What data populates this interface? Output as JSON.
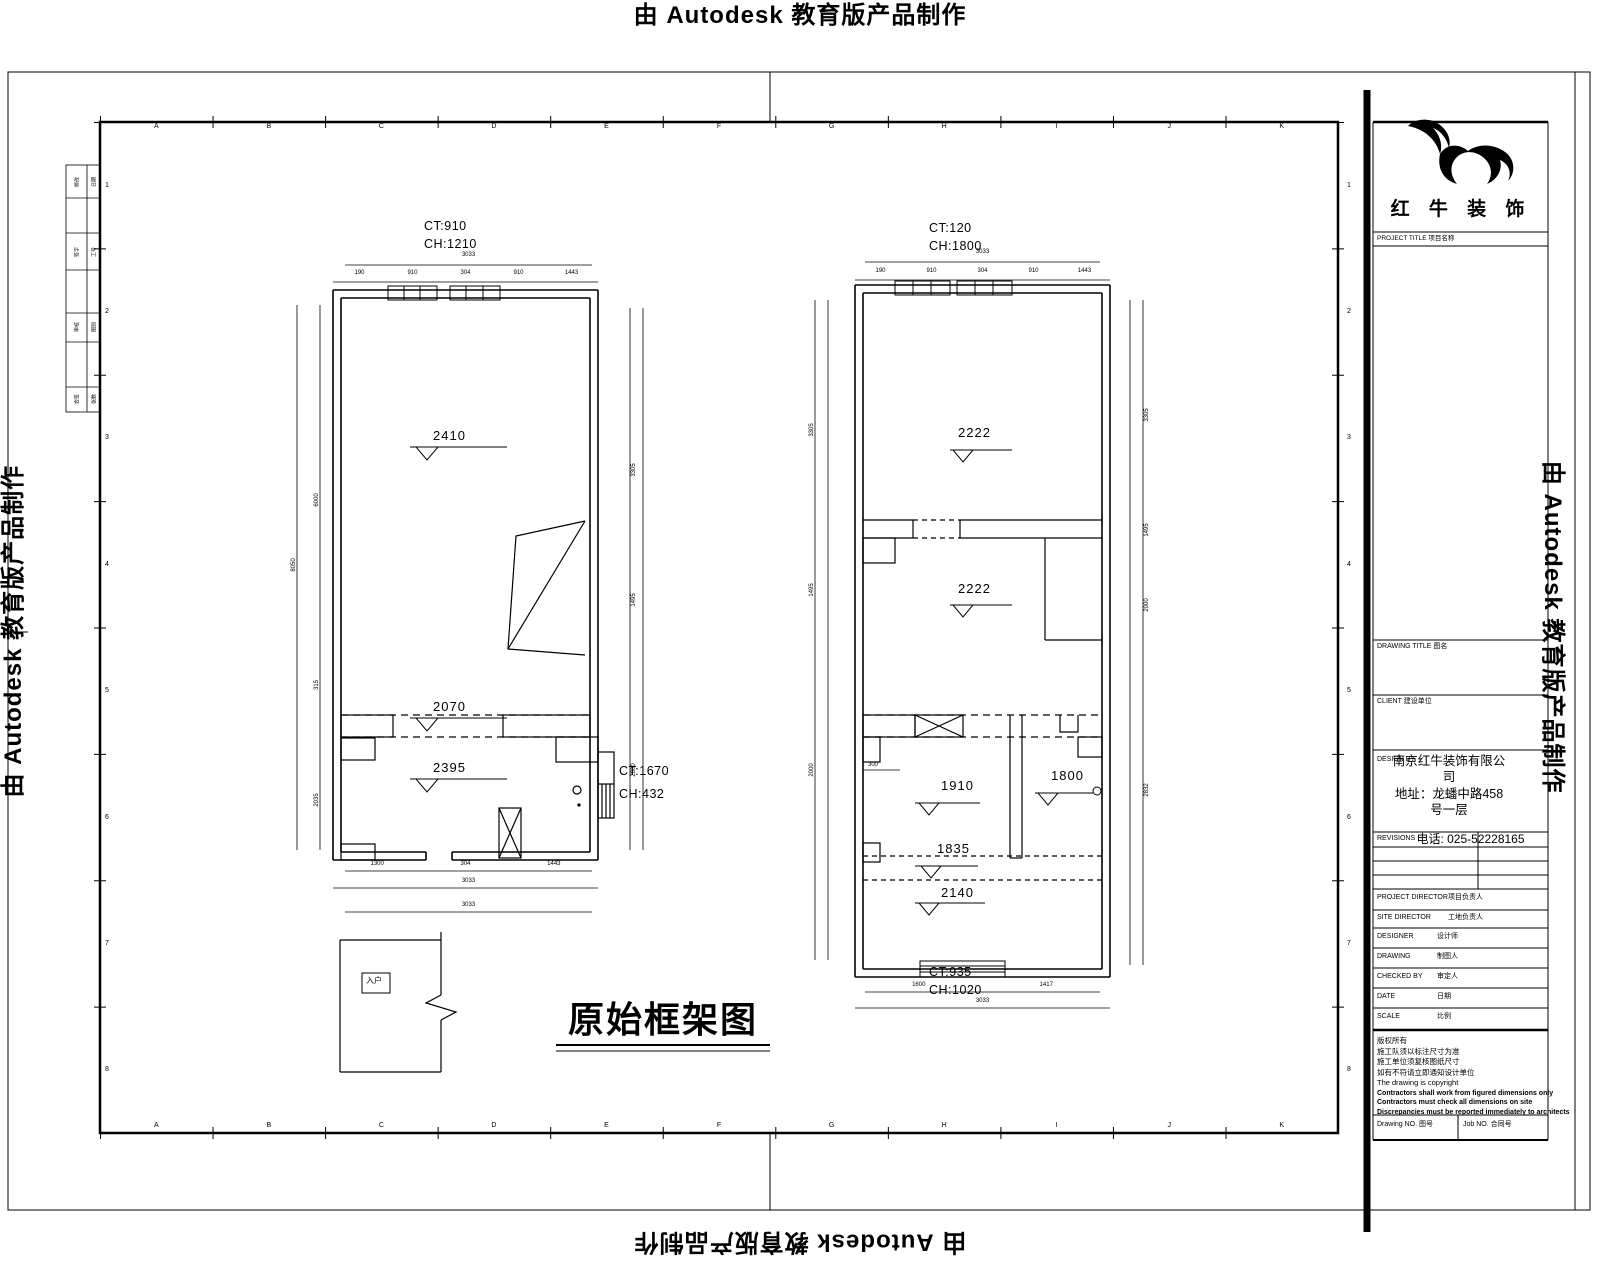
{
  "watermark": {
    "text": "由 Autodesk 教育版产品制作"
  },
  "sheet_title": {
    "text": "原始框架图"
  },
  "grid": {
    "letters": [
      "A",
      "B",
      "C",
      "D",
      "E",
      "F",
      "G",
      "H",
      "I",
      "J",
      "K"
    ],
    "rows": [
      "1",
      "2",
      "3",
      "4",
      "5",
      "6",
      "7",
      "8"
    ]
  },
  "edge_strip": {
    "rows": [
      [
        "修改",
        "日期"
      ],
      [
        "签字",
        "工号"
      ],
      [
        "审核",
        "图别"
      ],
      [
        "会签",
        "张数"
      ]
    ]
  },
  "left_plan": {
    "ct": "CT:910",
    "ch": "CH:1210",
    "levels": {
      "top": "2410",
      "beam": "2070",
      "mid": "2395"
    },
    "side": {
      "ct": "CT:1670",
      "ch": "CH:432"
    },
    "dim_top": {
      "total": "3033",
      "segments": [
        "190",
        "910",
        "304",
        "910",
        "1443"
      ]
    },
    "dim_bottom": {
      "segments": [
        "1300",
        "304",
        "1443"
      ],
      "total": "3033",
      "total2": "3033"
    },
    "dim_left": {
      "total": "8050",
      "segments": [
        "6000",
        "315",
        "2035"
      ]
    },
    "dim_right": {
      "segments": [
        "3305",
        "1495",
        "2000"
      ]
    },
    "balcony_label": "入户"
  },
  "right_plan": {
    "ct": "CT:120",
    "ch": "CH:1800",
    "bottom_ct": "CT:935",
    "bottom_ch": "CH:1020",
    "levels": {
      "room1": "2222",
      "room2": "2222",
      "room3": "1910",
      "room3b": "1800",
      "beam": "1835",
      "room4": "2140"
    },
    "small_dim": "300",
    "dim_top": {
      "total": "3033",
      "segments": [
        "190",
        "910",
        "304",
        "910",
        "1443"
      ]
    },
    "dim_bottom": {
      "segments": [
        "1600",
        "1417"
      ],
      "total": "3033"
    },
    "dim_left": {
      "segments": [
        "3305",
        "1495",
        "2000"
      ]
    },
    "dim_right": {
      "segments": [
        "3305",
        "1495",
        "2000",
        "2832"
      ]
    }
  },
  "titleblock": {
    "brand": "红 牛 装 饰",
    "project_row": "PROJECT TITLE 项目名称",
    "drawing_title_label": "DRAWING TITLE 图名",
    "client_label": "CLIENT 建设单位",
    "design_label": "DESIGN BY",
    "company": "南京红牛装饰有限公司",
    "address": "地址：龙蟠中路458号一层",
    "phone": "电话: 025-52228165",
    "revisions_label": "REVISIONS",
    "rows": [
      {
        "en": "PROJECT DIRECTOR",
        "zh": "项目负责人"
      },
      {
        "en": "SITE DIRECTOR",
        "zh": "工地负责人"
      },
      {
        "en": "DESIGNER",
        "zh": "设计师"
      },
      {
        "en": "DRAWING",
        "zh": "制图人"
      },
      {
        "en": "CHECKED BY",
        "zh": "审定人"
      },
      {
        "en": "DATE",
        "zh": "日期"
      },
      {
        "en": "SCALE",
        "zh": "比例"
      }
    ],
    "notes": [
      "版权所有",
      "施工队须以标注尺寸为准",
      "施工单位须复核图纸尺寸",
      "如有不符请立即通知设计单位",
      "The drawing is copyright",
      "Contractors shall work from figured dimensions only",
      "Contractors must check all dimensions on site",
      "Discrepancies must be reported immediately to architects"
    ],
    "drawing_no_label": "Drawing NO. 图号",
    "job_no_label": "Job NO. 合同号"
  }
}
